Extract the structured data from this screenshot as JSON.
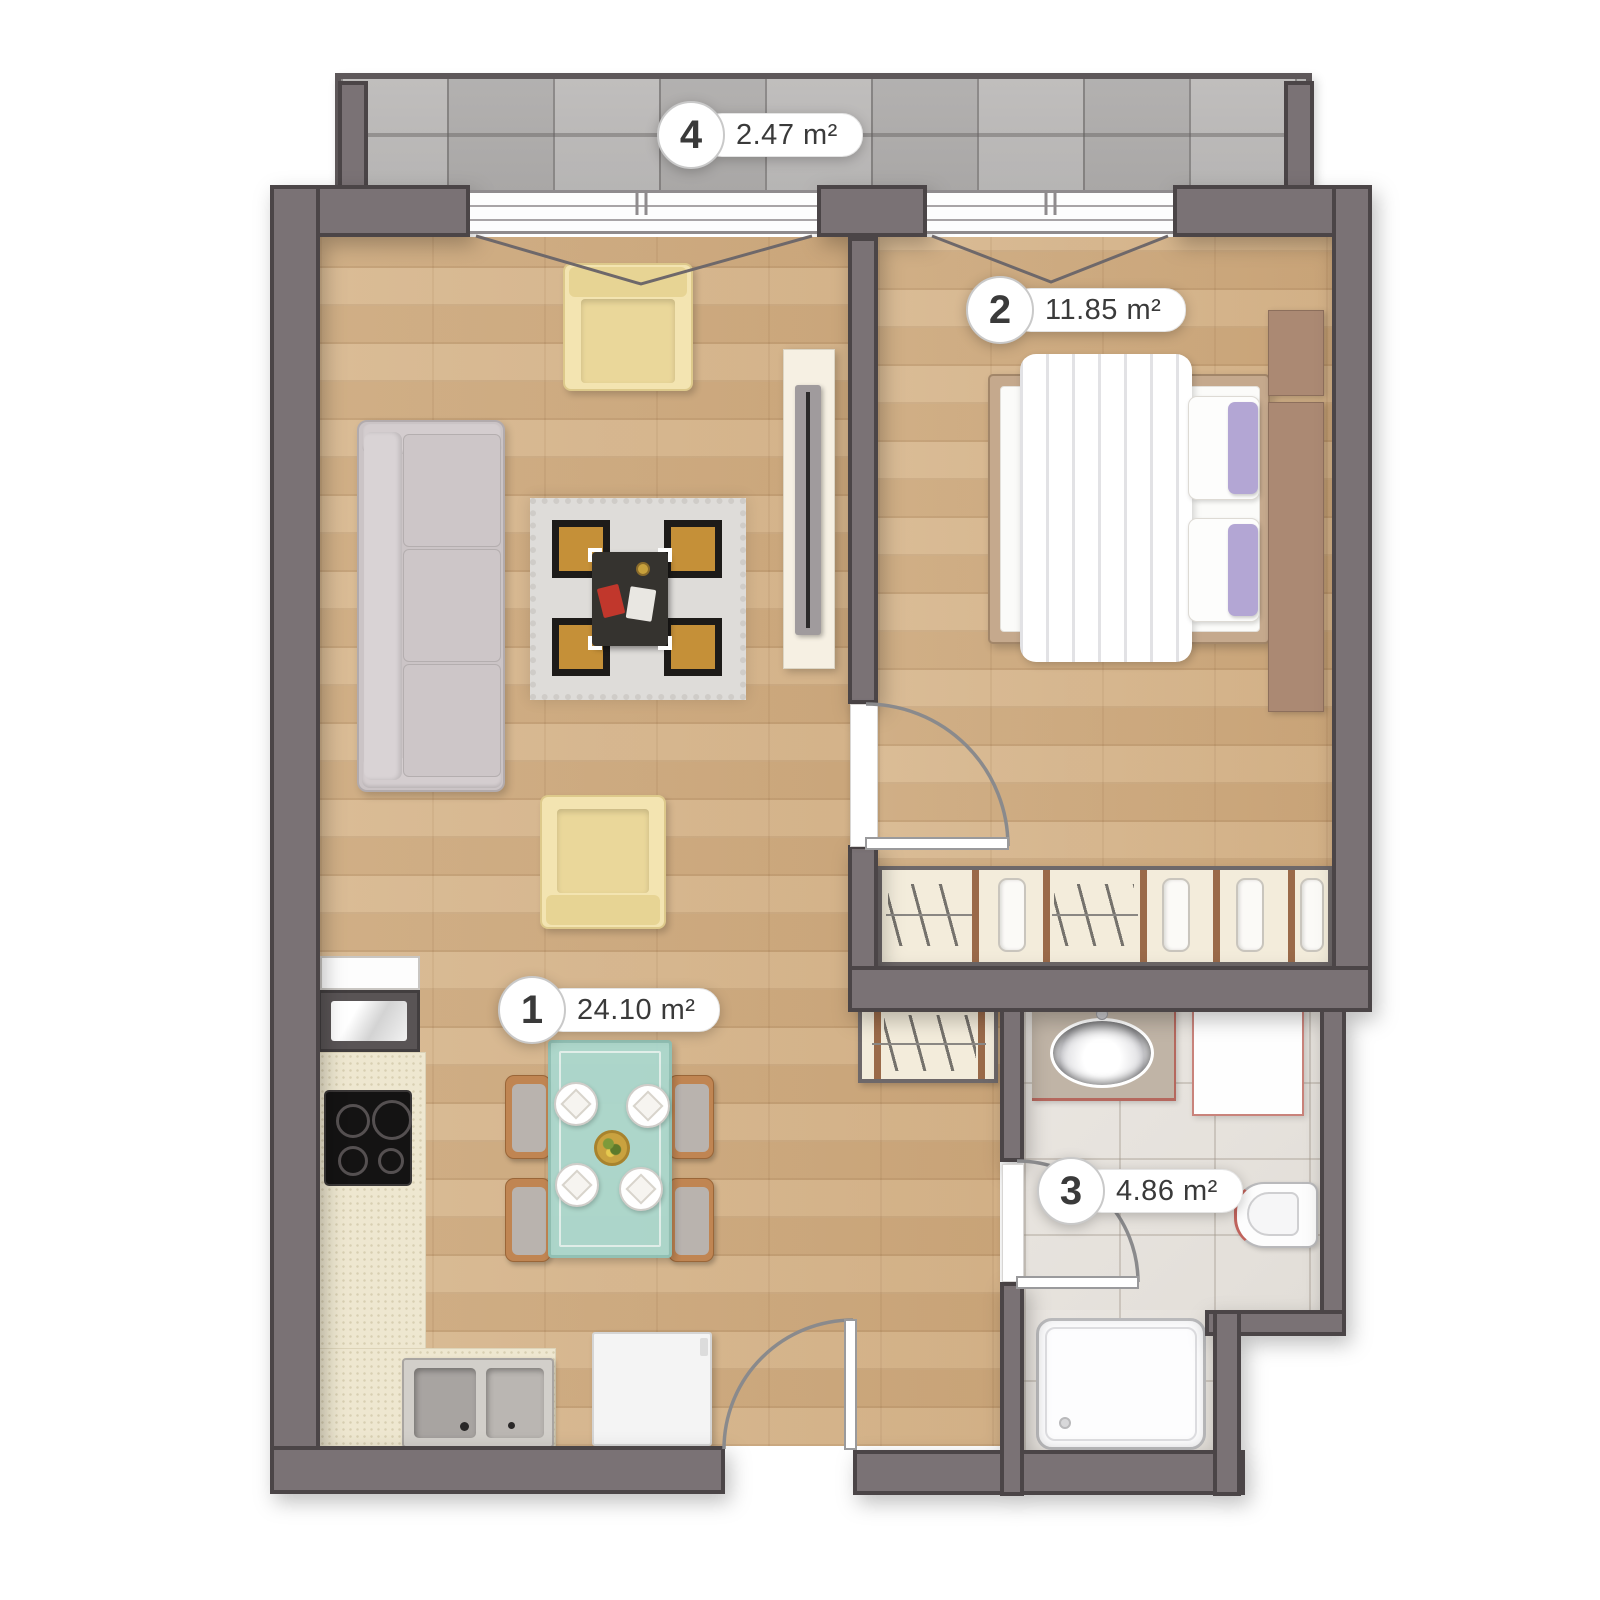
{
  "rooms": [
    {
      "number": "1",
      "area": "24.10 m²"
    },
    {
      "number": "2",
      "area": "11.85 m²"
    },
    {
      "number": "3",
      "area": "4.86 m²"
    },
    {
      "number": "4",
      "area": "2.47 m²"
    }
  ],
  "colors": {
    "wall": "#7a7275",
    "wall_outline": "#4b4547",
    "wood": "#d8b88f",
    "balcony_tile": "#bcbab9",
    "bath_tile": "#eae6e1",
    "cream": "#f3ecdb",
    "trim": "#9a6a49",
    "sofa": "#cbc4c6",
    "armchair": "#f3e4b1",
    "rug_base": "#dedcd9",
    "rug_gold": "#c59038",
    "glass": "#abd8ce",
    "chair": "#c08552",
    "bed_frame": "#c5a98d",
    "pillow_accent": "#b3a6d4",
    "headboard": "#ab8973",
    "counter": "#eee7d0",
    "appliance": "#f4f4f4",
    "fixture_border": "#b9b9bb",
    "machine_border": "#c9837b",
    "label_text": "#3a3a3a",
    "label_border": "#c9c9c9",
    "arc": "#8a8a8c"
  }
}
